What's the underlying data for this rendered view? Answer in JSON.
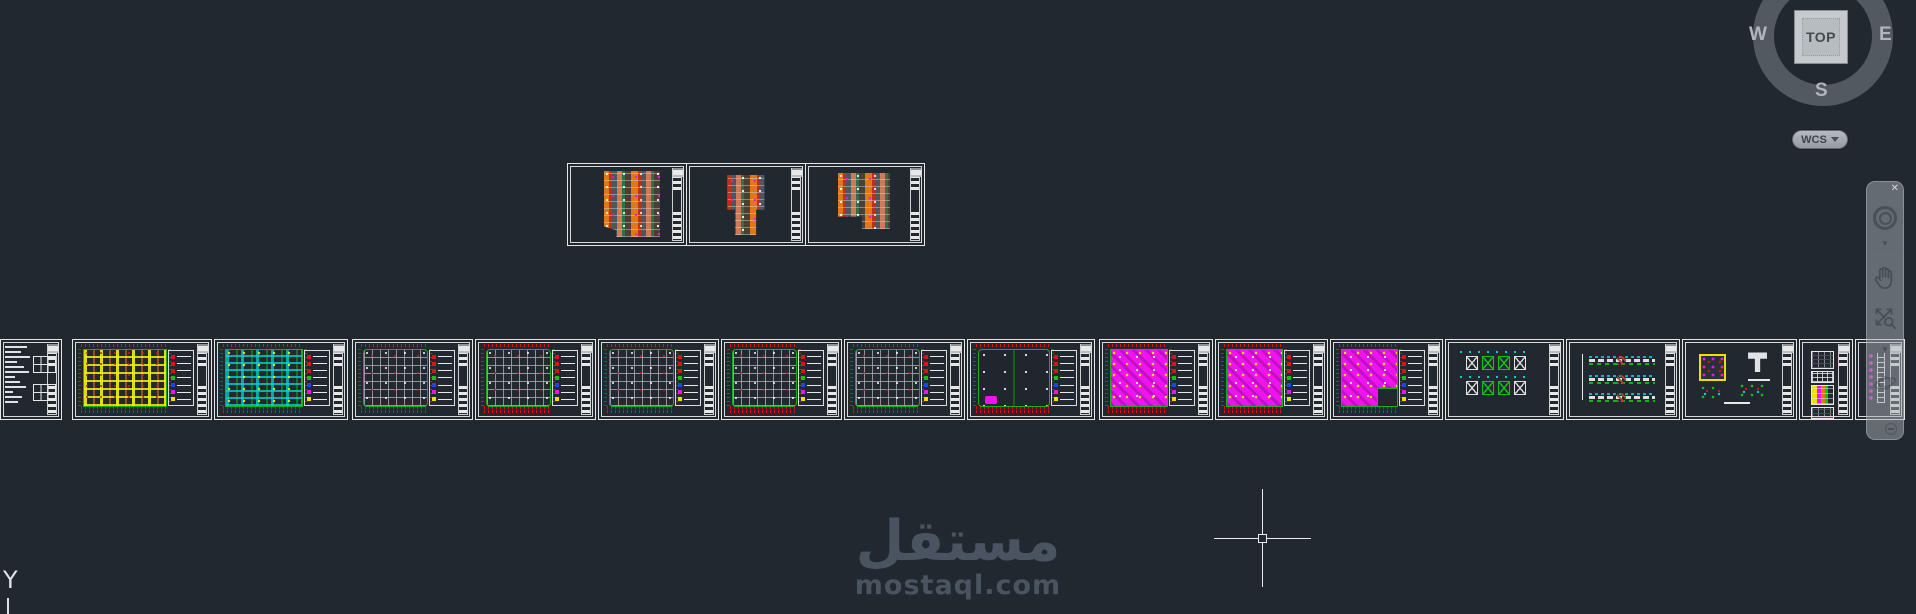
{
  "app": {
    "background": "#212830",
    "frame_color": "#e8e8e8"
  },
  "viewcube": {
    "top_label": "TOP",
    "west": "W",
    "east": "E",
    "south": "S",
    "wcs_label": "WCS"
  },
  "navigation_bar": {
    "icons": [
      "close-icon",
      "navigation-wheel-icon",
      "caret-down-icon",
      "pan-hand-icon",
      "zoom-icon",
      "caret-down-icon",
      "orbit-icon",
      "collapse-minus-icon"
    ]
  },
  "ucs": {
    "axis_label": "Y"
  },
  "watermark": {
    "arabic": "مستقل",
    "latin": "mostaql.com"
  },
  "crosshair": {
    "x": 1262,
    "y": 538
  },
  "palette": {
    "red": "#d81414",
    "green": "#14c014",
    "blue": "#2444e0",
    "magenta": "#ee14ee",
    "yellow": "#f0e000",
    "cyan": "#00d0d0",
    "orange": "#e07818",
    "grid_gray": "#b2b8be",
    "frame_white": "#e8e8e8"
  },
  "legend_swatches": [
    "#d81414",
    "#d81414",
    "#d81414",
    "#14c014",
    "#2444e0",
    "#ee14ee",
    "#f0e000"
  ],
  "top_sheets": [
    {
      "type": "arch-a"
    },
    {
      "type": "arch-b"
    },
    {
      "type": "arch-c"
    }
  ],
  "strip_sheets": [
    {
      "type": "notes",
      "w": 60,
      "gap": 0
    },
    {
      "type": "plan-yellow",
      "w": 138,
      "gap": 12
    },
    {
      "type": "plan-cyan",
      "w": 132,
      "gap": 4
    },
    {
      "type": "grid",
      "w": 119,
      "gap": 6
    },
    {
      "type": "grid",
      "w": 119,
      "gap": 4
    },
    {
      "type": "grid",
      "w": 119,
      "gap": 4
    },
    {
      "type": "grid",
      "w": 119,
      "gap": 4
    },
    {
      "type": "grid",
      "w": 119,
      "gap": 4
    },
    {
      "type": "sparse",
      "w": 126,
      "gap": 4
    },
    {
      "type": "magenta",
      "w": 112,
      "gap": 6
    },
    {
      "type": "magenta",
      "w": 111,
      "gap": 4
    },
    {
      "type": "magenta",
      "w": 111,
      "gap": 4,
      "notch": true
    },
    {
      "type": "xbrace",
      "w": 117,
      "gap": 4
    },
    {
      "type": "beams",
      "w": 112,
      "gap": 4
    },
    {
      "type": "details",
      "w": 113,
      "gap": 4
    },
    {
      "type": "tables",
      "w": 52,
      "gap": 4
    },
    {
      "type": "dense",
      "w": 48,
      "gap": 4
    }
  ]
}
